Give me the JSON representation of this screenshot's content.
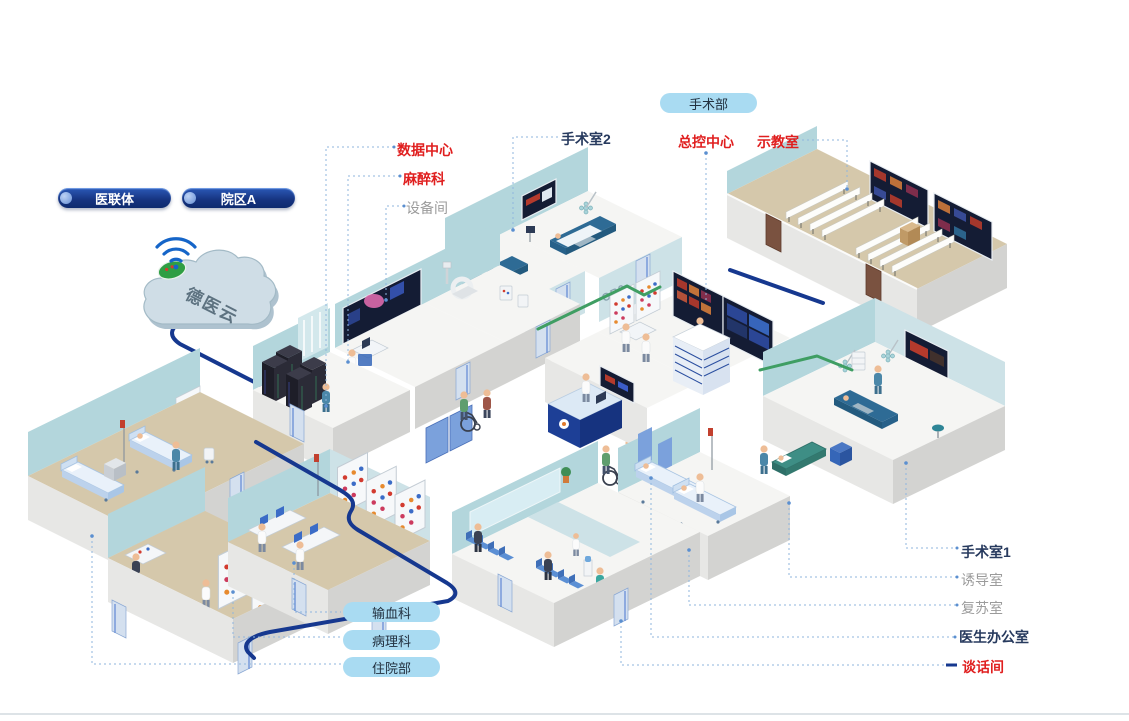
{
  "network": {
    "hospital_union": "医联体",
    "campus_a": "院区A",
    "cloud_label": "德医云"
  },
  "departments": {
    "surgery_dept": "手术部",
    "blood_transfusion": "输血科",
    "pathology": "病理科",
    "inpatient": "住院部"
  },
  "rooms": {
    "data_center": "数据中心",
    "anesthesia": "麻醉科",
    "equipment_room": "设备间",
    "operating_room_2": "手术室2",
    "master_control": "总控中心",
    "demo_classroom": "示教室",
    "operating_room_1": "手术室1",
    "induction_room": "诱导室",
    "recovery_room": "复苏室",
    "doctor_office": "医生办公室",
    "talk_room": "谈话间"
  },
  "wall_marks": {
    "or2": "OR2",
    "or3": "OR3"
  },
  "icons": [
    "wifi-icon",
    "cloud-icon",
    "brand-badge"
  ],
  "colors": {
    "red_label": "#e01f1f",
    "navy_label": "#273a5e",
    "gray_label": "#9b9b9b",
    "cable_blue": "#16388f",
    "cable_green": "#3f9e63",
    "pill_navy": "#16337f",
    "pill_light_blue": "#a9dbf2",
    "wall_teal": "#b3d6dc",
    "floor_beige": "#d5c8ab"
  }
}
